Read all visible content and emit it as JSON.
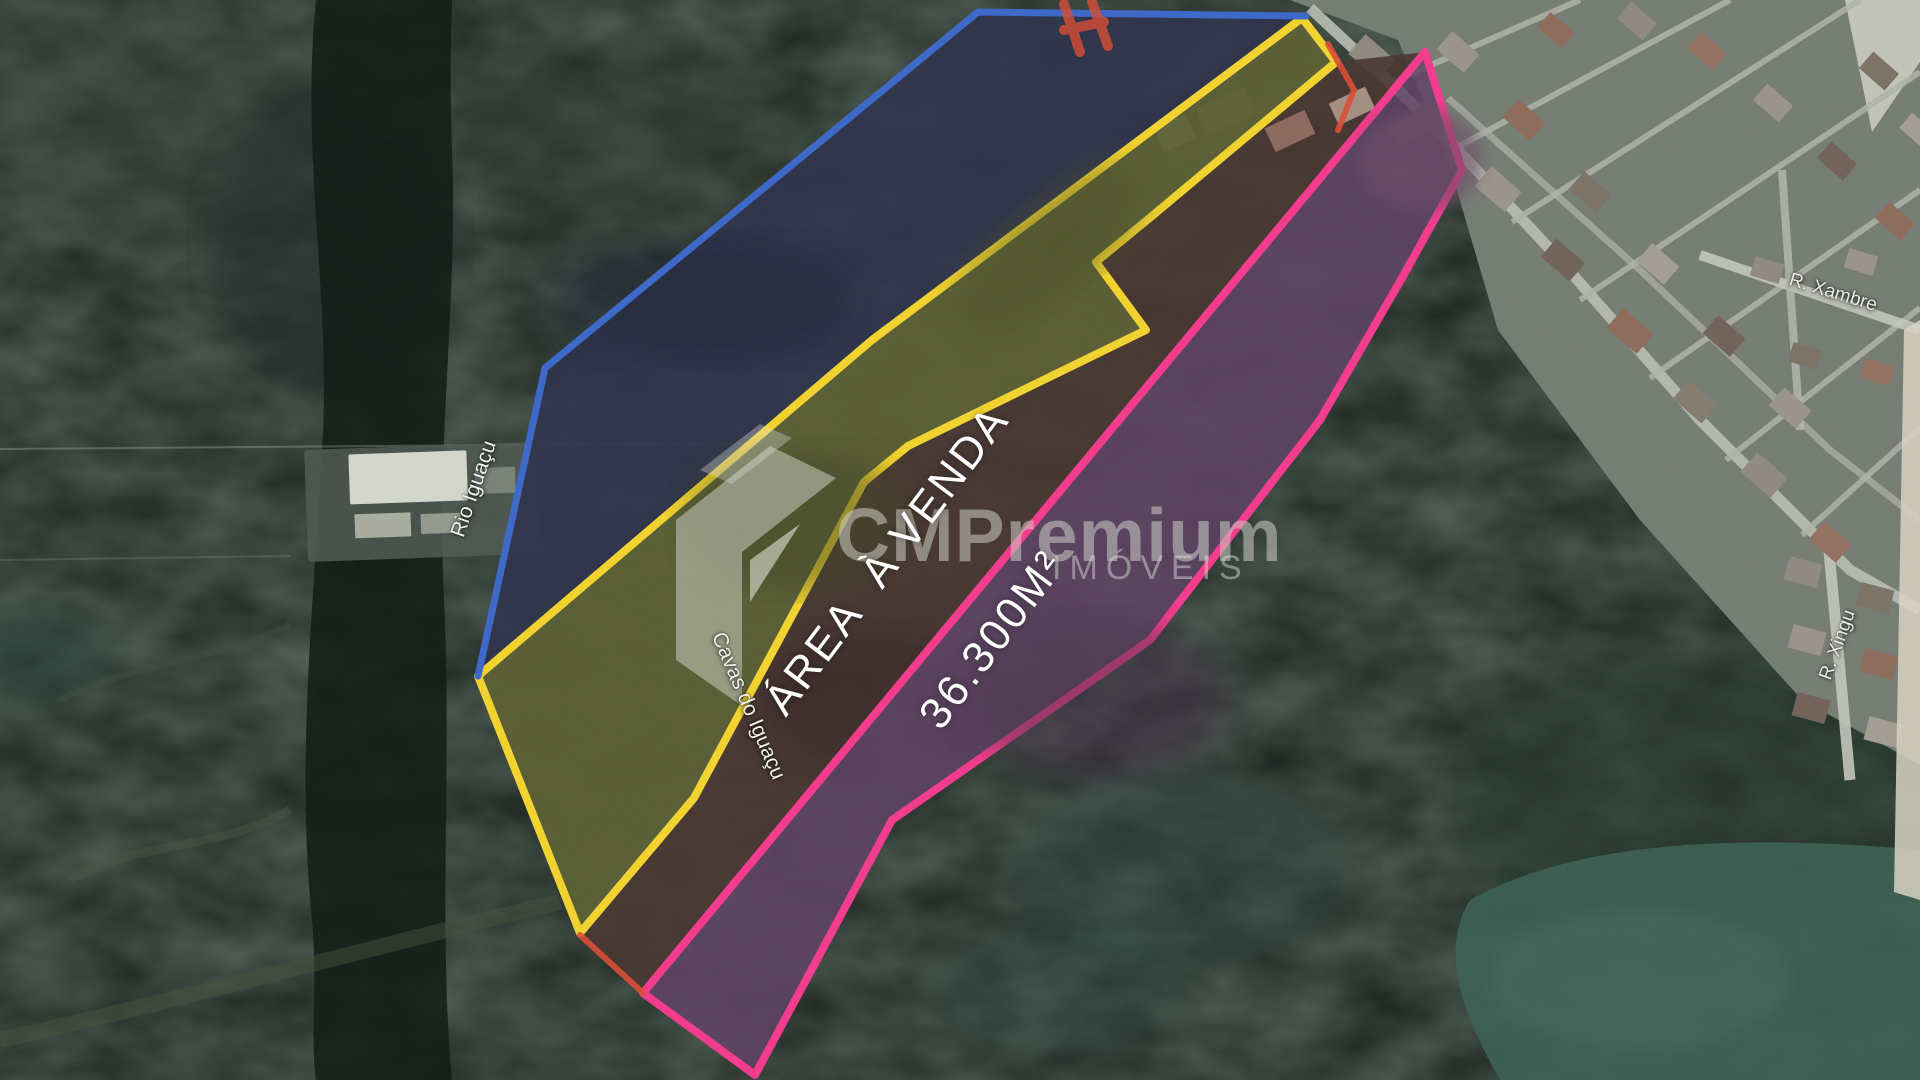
{
  "photo": {
    "area_overlay": {
      "line1": "ÁREA  À VENDA",
      "line2": "36.300M²"
    },
    "place_labels": {
      "river": "Rio Iguaçu",
      "cavas": "Cavas do Iguaçu",
      "street_top": "R. Xambre",
      "street_right": "R. Xingu"
    },
    "watermark": {
      "brand": "CMPremium",
      "subtitle": "IMÓVEIS"
    },
    "colors": {
      "boundary_blue": "#3a66c9",
      "boundary_yellow": "#f2d32b",
      "boundary_pink": "#f4388b",
      "boundary_red": "#d94a33",
      "overlay_text": "#ffffff"
    }
  }
}
